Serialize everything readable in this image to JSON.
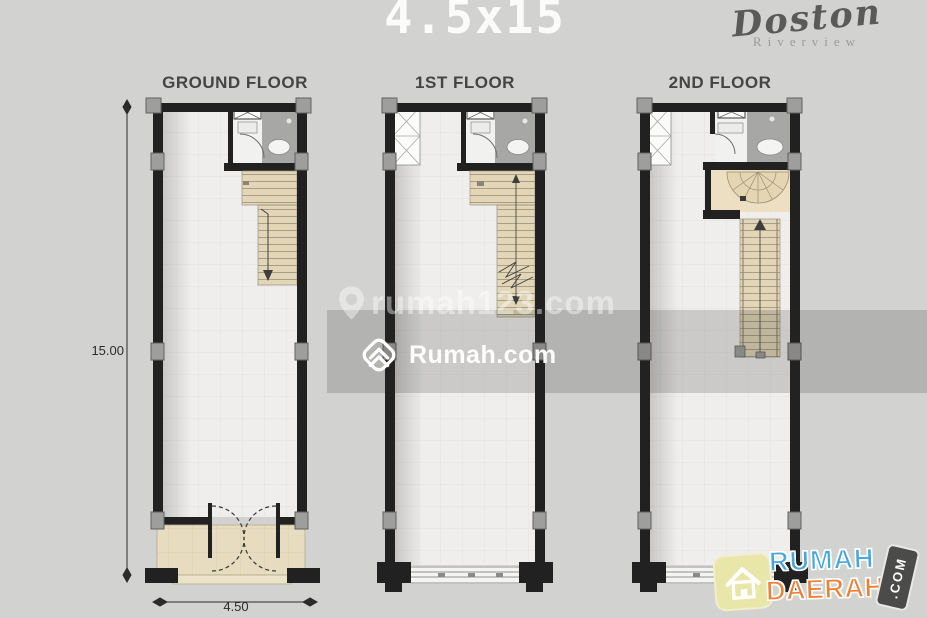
{
  "header": {
    "title": "4.5x15",
    "brand": {
      "name": "Doston",
      "subtitle": "Riverview"
    }
  },
  "floors": [
    {
      "label": "GROUND FLOOR"
    },
    {
      "label": "1ST FLOOR"
    },
    {
      "label": "2ND FLOOR"
    }
  ],
  "dimensions": {
    "height_label": "15.00",
    "width_label": "4.50"
  },
  "watermarks": {
    "site1": "rumah123.com",
    "site2": "Rumah.com"
  },
  "footer_logo": {
    "line1": "RUMAH",
    "line2": "DAERAH",
    "suffix": ".COM"
  },
  "colors": {
    "background": "#d2d2d1",
    "walls": "#212121",
    "floor_tile": "#efeeec",
    "bathroom": "#a7a7a6",
    "stairs_beige": "#e2d6b6",
    "terrace_beige": "#e7dcc0",
    "watermark_band": "rgba(40,40,38,0.18)",
    "logo_blue": "#45a8da",
    "logo_orange": "#ef7f35",
    "logo_badge_yellow": "#e9e6a9"
  }
}
